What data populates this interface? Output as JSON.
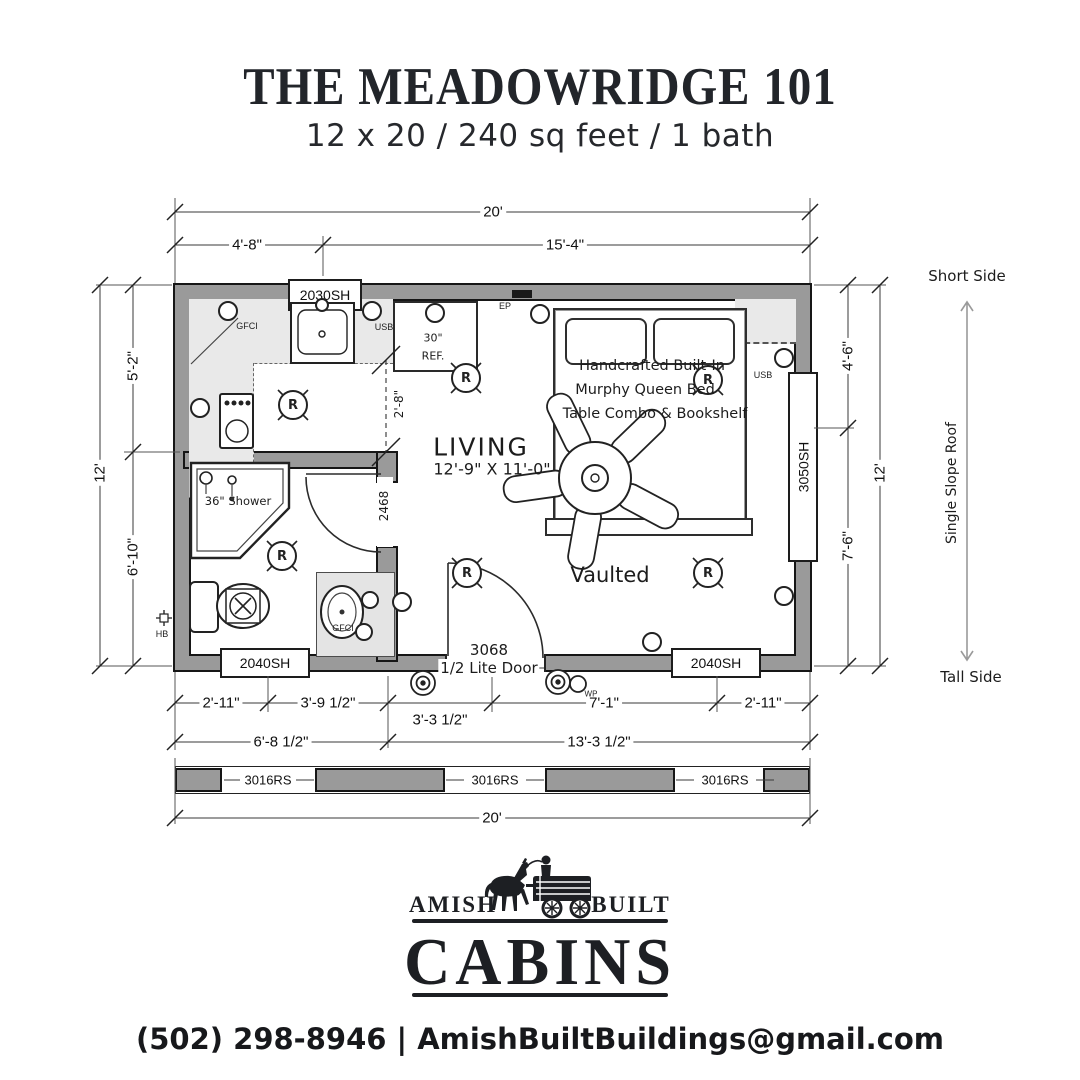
{
  "header": {
    "title": "THE MEADOWRIDGE 101",
    "subtitle": "12 x 20 / 240 sq feet / 1 bath"
  },
  "dims": {
    "top_total": "20'",
    "top_left": "4'-8\"",
    "top_right": "15'-4\"",
    "left_total": "12'",
    "left_upper": "5'-2\"",
    "left_lower": "6'-10\"",
    "right_upper": "4'-6\"",
    "right_lower": "7'-6\"",
    "right_total": "12'",
    "bottom_1": "2'-11\"",
    "bottom_2": "3'-9 1/2\"",
    "bottom_3": "3'-3 1/2\"",
    "bottom_4": "7'-1\"",
    "bottom_5": "2'-11\"",
    "bottom_left_total": "6'-8 1/2\"",
    "bottom_right_total": "13'-3 1/2\"",
    "bottom_total": "20'",
    "kitchen_clearance": "2'-8\""
  },
  "windows": {
    "w2030": "2030SH",
    "w3050": "3050SH",
    "w2040": "2040SH",
    "w3016": "3016RS"
  },
  "doors": {
    "entry_size": "3068",
    "entry_type": "1/2 Lite Door",
    "bath": "2468"
  },
  "rooms": {
    "living": "LIVING",
    "living_size": "12'-9\" X 11'-0\"",
    "vaulted": "Vaulted",
    "shower": "36\" Shower",
    "fridge_size": "30\"",
    "fridge": "REF.",
    "bed_line1": "Handcrafted Built-In",
    "bed_line2": "Murphy Queen Bed",
    "bed_line3": "Table Combo & Bookshelf"
  },
  "electrical": {
    "gfci": "GFCI",
    "usb": "USB",
    "ep": "EP",
    "wp": "WP",
    "hb": "HB",
    "recessed": "R"
  },
  "roof": {
    "short_side": "Short Side",
    "label": "Single Slope Roof",
    "tall_side": "Tall Side"
  },
  "footer": {
    "brand_left": "AMISH",
    "brand_right": "BUILT",
    "brand_main": "CABINS",
    "contact": "(502) 298-8946 | AmishBuiltBuildings@gmail.com"
  }
}
